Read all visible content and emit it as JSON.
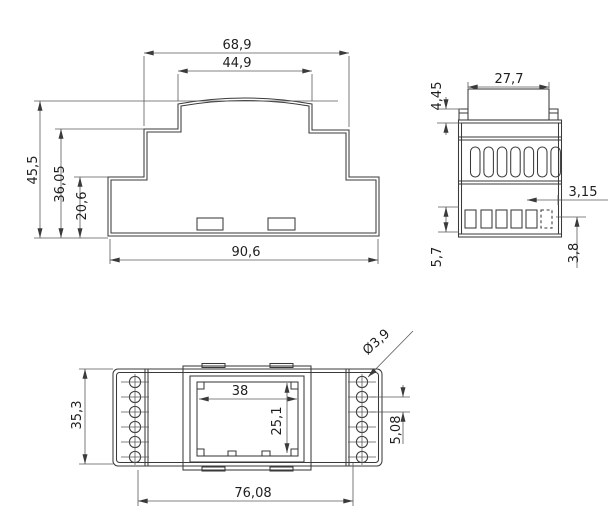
{
  "drawing": {
    "colors": {
      "line": "#3a3a3a",
      "background": "#ffffff"
    },
    "side_view": {
      "top_width": "68,9",
      "upper_width": "44,9",
      "total_height": "45,5",
      "middle_height": "36,05",
      "lower_height": "20,6",
      "base_width": "90,6"
    },
    "front_view": {
      "top_tab_width": "27,7",
      "tab_height": "4,45",
      "terminal_width": "3,15",
      "terminal_row_height": "5,7",
      "terminal_bottom_offset": "3,8"
    },
    "top_view": {
      "window_width": "38",
      "window_height": "25,1",
      "body_depth": "35,3",
      "mounting_width": "76,08",
      "hole_pitch": "5,08",
      "hole_diameter": "Ø3,9"
    }
  }
}
